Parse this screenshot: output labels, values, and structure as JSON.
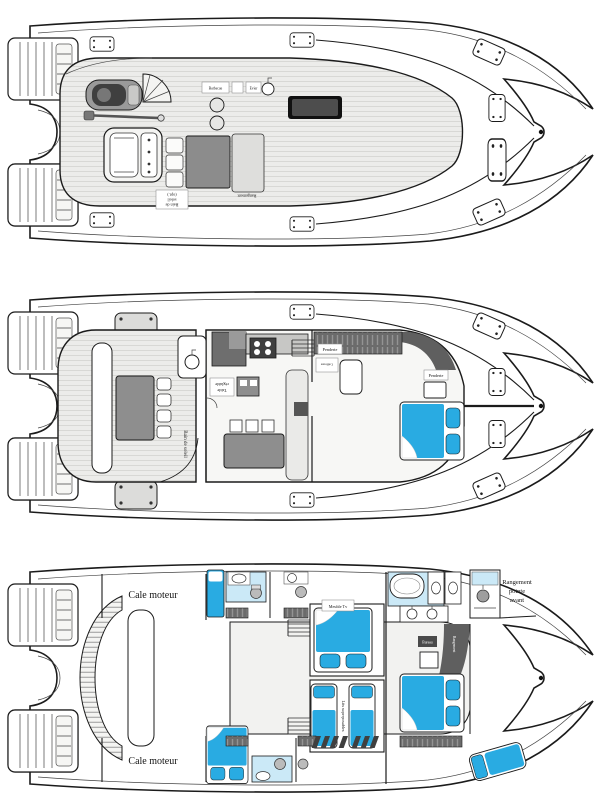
{
  "figure": {
    "kind": "catamaran yacht deck plans, three decks stacked vertically"
  },
  "colors": {
    "bed_blue": "#29ABE2",
    "bath_blue": "#CBE9F7",
    "outline": "#1B1B1B",
    "furniture_gray": "#8E8E8E",
    "wardrobe_gray": "#5F5F5F",
    "teak_deck": "#ECECEA"
  },
  "flybridge": {
    "labels": {
      "barbecue": "Barbecue",
      "sink": "Evier",
      "storage": "Rangement",
      "note_l1": "Bain de",
      "note_l2": "soleil",
      "note_l3": "(opt.)"
    }
  },
  "main_deck": {
    "labels": {
      "table_l1": "Table",
      "table_l2": "réglable",
      "sunbed": "Bain de soleil",
      "wardrobe_fwd": "Penderie",
      "wardrobe_fwd2": "Penderie",
      "vanity": "Coiffeuse"
    }
  },
  "lower_deck": {
    "labels": {
      "engine_room": "Cale moteur",
      "tv": "Meuble Tv",
      "bunks": "Lits superposables",
      "desk": "Bureau",
      "wardrobe": "Rangement",
      "bow_l1": "Rangement",
      "bow_l2": "pointe",
      "bow_l3": "avant"
    }
  }
}
